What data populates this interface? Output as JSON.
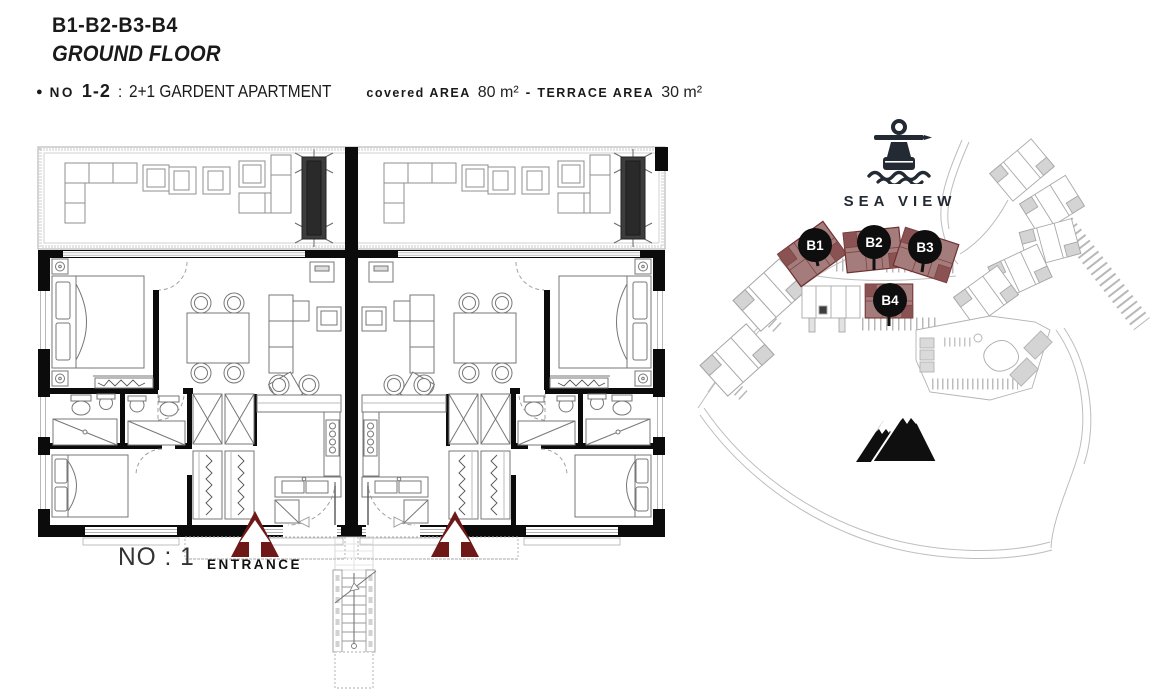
{
  "header": {
    "project_title": "B1-B2-B3-B4",
    "floor_title": "GROUND FLOOR",
    "info": {
      "bullet": "●",
      "no_label": "NO",
      "no_value": "1-2",
      "colon": ":",
      "apartment_type": "2+1 GARDENT APARTMENT",
      "covered_label": "covered AREA",
      "covered_value": "80 m²",
      "dash": "-",
      "terrace_label": "TERRACE AREA",
      "terrace_value": "30 m²"
    }
  },
  "floor_plan": {
    "unit_number_label": "NO : 1",
    "entrance_label": "ENTRANCE"
  },
  "site_plan": {
    "sea_view_label": "SEA VIEW",
    "markers": [
      {
        "id": "B1"
      },
      {
        "id": "B2"
      },
      {
        "id": "B3"
      },
      {
        "id": "B4"
      }
    ]
  },
  "colors": {
    "wall": "#0b0b0b",
    "plan_line": "#8f8f8f",
    "site_line": "#aeaeae",
    "highlight_fill": "#a57c7c",
    "highlight_stroke": "#6f3030",
    "highlight_inner": "#7d4343",
    "marker_bg": "#0e0e0e",
    "marker_text": "#ffffff",
    "arrow": "#6e1818",
    "icon_dark": "#232a33"
  }
}
